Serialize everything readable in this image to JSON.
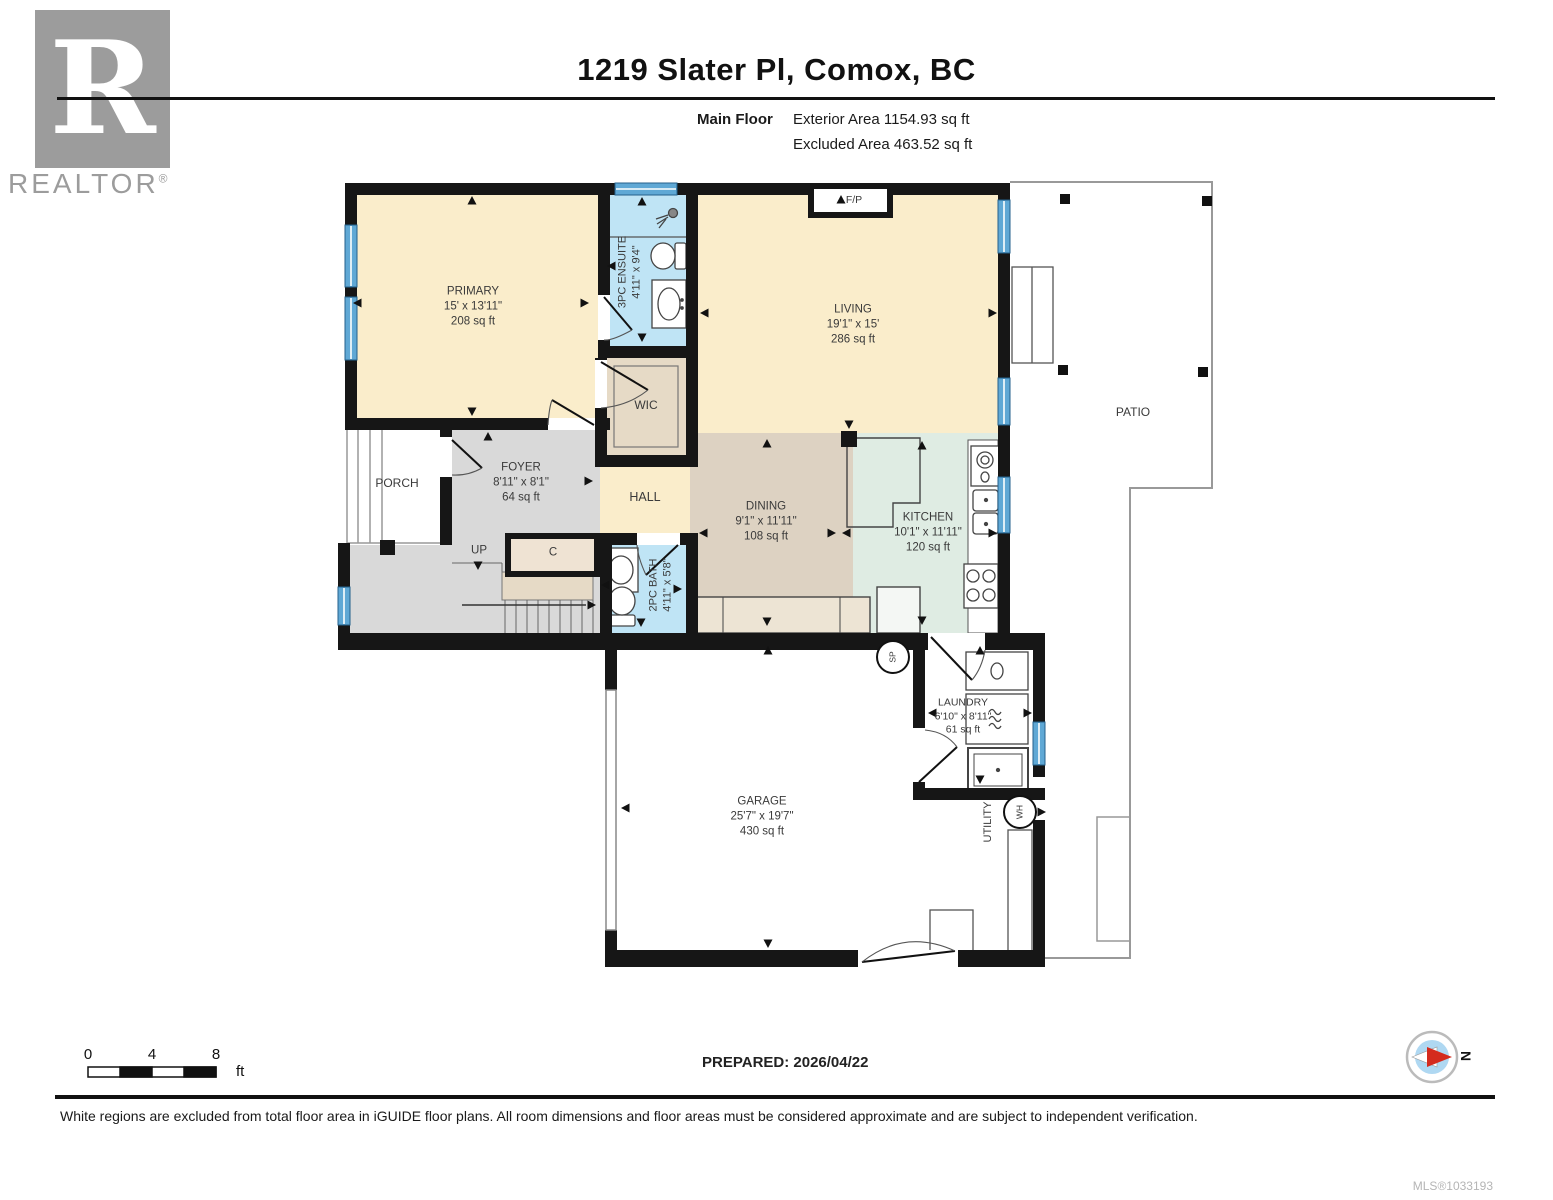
{
  "header": {
    "logo_letter": "R",
    "logo_text": "REALTOR",
    "logo_reg": "®",
    "title": "1219 Slater Pl, Comox, BC",
    "floor_label": "Main Floor",
    "exterior_area": "Exterior Area 1154.93 sq ft",
    "excluded_area": "Excluded Area 463.52 sq ft"
  },
  "rooms": [
    {
      "name": "PRIMARY",
      "dims": "15' x 13'11\"",
      "area": "208 sq ft"
    },
    {
      "name": "LIVING",
      "dims": "19'1\" x 15'",
      "area": "286 sq ft"
    },
    {
      "name": "FOYER",
      "dims": "8'11\" x 8'1\"",
      "area": "64 sq ft"
    },
    {
      "name": "DINING",
      "dims": "9'1\" x 11'11\"",
      "area": "108 sq ft"
    },
    {
      "name": "KITCHEN",
      "dims": "10'1\" x 11'11\"",
      "area": "120 sq ft"
    },
    {
      "name": "GARAGE",
      "dims": "25'7\" x 19'7\"",
      "area": "430 sq ft"
    },
    {
      "name": "LAUNDRY",
      "dims": "6'10\" x 8'11\"",
      "area": "61 sq ft"
    },
    {
      "name": "3PC ENSUITE",
      "dims": "4'11\" x 9'4\""
    },
    {
      "name": "2PC BATH",
      "dims": "4'11\" x 5'8\""
    }
  ],
  "labels": {
    "wic": "WIC",
    "hall": "HALL",
    "porch": "PORCH",
    "patio": "PATIO",
    "utility": "UTILITY",
    "up": "UP",
    "closet": "C",
    "fireplace": "F/P",
    "sump": "SP",
    "water_heater": "WH",
    "compass_north": "N"
  },
  "scale_bar": {
    "tick0": "0",
    "tick4": "4",
    "tick8": "8",
    "unit": "ft"
  },
  "footer": {
    "prepared": "PREPARED: 2026/04/22",
    "disclaimer": "White regions are excluded from total floor area in iGUIDE floor plans. All room dimensions and floor areas must be considered approximate and are subject to independent verification.",
    "mls": "MLS®1033193"
  },
  "colors": {
    "cream": "#FAEDCB",
    "tan": "#E6DAC6",
    "dining_tan": "#DDD2C2",
    "bath_blue": "#BFE4F5",
    "kitchen_mint": "#DFECE3",
    "foyer_gray": "#D9D9D9",
    "window_blue": "#5FA8D5",
    "wall": "#161616"
  }
}
